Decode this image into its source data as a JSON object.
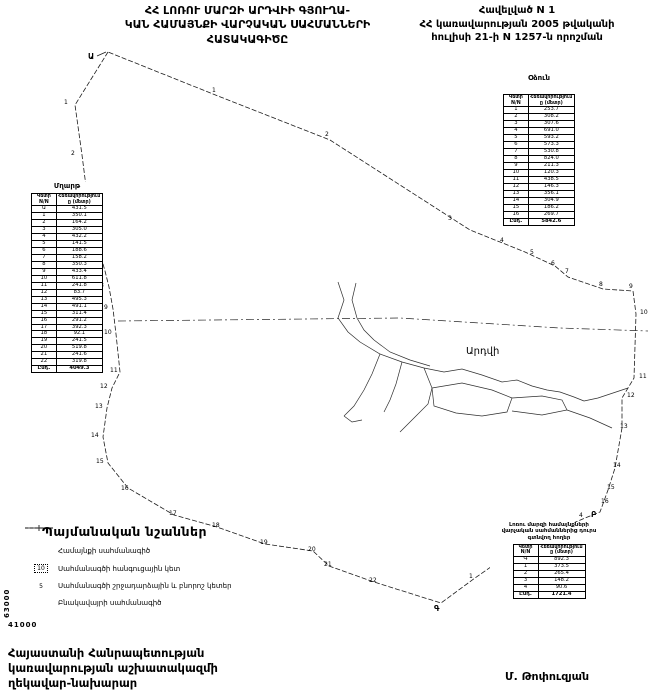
{
  "header": {
    "title_lines": [
      "ՀՀ ԼՈՌՈՒ ՄԱՐԶԻ ԱՐԴՎԻԻ ԳՅՈՒՂԱ-",
      "ԿԱՆ ՀԱՄԱՅՆՔԻ ՎԱՐՉԱԿԱՆ ՍԱՀՄԱՆՆԵՐԻ",
      "ՀԱՏԱԿԱԳԻԾԸ"
    ],
    "annex_lines": [
      "Հավելված N 1",
      "ՀՀ կառավարության 2005 թվականի",
      "հուլիսի 21-ի N 1257-ն որոշման"
    ]
  },
  "tables": {
    "left": {
      "title": "Մղարթ",
      "col1": "Կետի N/N",
      "col2": "Հեռավորությունը (մետր)",
      "rows": [
        [
          "Ա",
          "431.5"
        ],
        [
          "1",
          "350.1"
        ],
        [
          "2",
          "164.2"
        ],
        [
          "3",
          "305.0"
        ],
        [
          "4",
          "432.2"
        ],
        [
          "5",
          "141.5"
        ],
        [
          "6",
          "188.6"
        ],
        [
          "7",
          "158.2"
        ],
        [
          "8",
          "350.3"
        ],
        [
          "9",
          "433.4"
        ],
        [
          "10",
          "611.8"
        ],
        [
          "11",
          "241.8"
        ],
        [
          "12",
          "83.7"
        ],
        [
          "13",
          "495.3"
        ],
        [
          "14",
          "491.1"
        ],
        [
          "15",
          "311.4"
        ],
        [
          "16",
          "291.2"
        ],
        [
          "17",
          "392.3"
        ],
        [
          "18",
          "92.1"
        ],
        [
          "19",
          "241.5"
        ],
        [
          "20",
          "519.8"
        ],
        [
          "21",
          "241.6"
        ],
        [
          "22",
          "319.8"
        ]
      ],
      "total_label": "Ընդ.",
      "total": "4049.3"
    },
    "right": {
      "title": "Օձուն",
      "col1": "Կետի N/N",
      "col2": "Հեռավորությունը (մետր)",
      "rows": [
        [
          "1",
          "253.7"
        ],
        [
          "2",
          "308.2"
        ],
        [
          "3",
          "307.6"
        ],
        [
          "4",
          "691.0"
        ],
        [
          "5",
          "593.2"
        ],
        [
          "6",
          "573.3"
        ],
        [
          "7",
          "530.8"
        ],
        [
          "8",
          "824.0"
        ],
        [
          "9",
          "211.3"
        ],
        [
          "10",
          "120.3"
        ],
        [
          "11",
          "438.5"
        ],
        [
          "12",
          "146.3"
        ],
        [
          "13",
          "356.1"
        ],
        [
          "14",
          "304.9"
        ],
        [
          "15",
          "186.2"
        ],
        [
          "16",
          "269.7"
        ]
      ],
      "total_label": "Ընդ.",
      "total": "5842.6"
    },
    "outside": {
      "title_lines": [
        "Լոռու մարզի համայնքների",
        "վարչական սահմաններից դուրս",
        "գտնվող հողեր"
      ],
      "col1": "Կետի N/N",
      "col2": "Հեռավորությունը (մետր)",
      "rows": [
        [
          "Գ",
          "892.3"
        ],
        [
          "1",
          "373.5"
        ],
        [
          "2",
          "265.4"
        ],
        [
          "3",
          "148.2"
        ],
        [
          "4",
          "90.6"
        ]
      ],
      "total_label": "Ընդ.",
      "total": "1721.4"
    }
  },
  "legend": {
    "title": "Պայմանական նշաններ",
    "items": [
      {
        "symbol": "community-boundary-line",
        "label": "Համայնքի սահմանագիծ"
      },
      {
        "symbol": "junction-point",
        "symbol_text": "10",
        "label": "Սահմանագծի հանգուցային կետ"
      },
      {
        "symbol": "turning-point",
        "symbol_text": "5",
        "label": "Սահմանագծի շրջադարձային և բնորոշ կետեր"
      },
      {
        "symbol": "settlement-boundary-line",
        "label": "Բնակավայրի սահմանագիծ"
      }
    ]
  },
  "map": {
    "settlement_label": "Արդվի",
    "point_groups": {
      "junctions": [
        {
          "n": "Ա",
          "x": 88,
          "y": 59,
          "big": true
        },
        {
          "n": "Բ",
          "x": 591,
          "y": 517,
          "big": true
        },
        {
          "n": "Գ",
          "x": 434,
          "y": 611,
          "big": true
        }
      ],
      "mghart": [
        {
          "n": "1",
          "x": 64,
          "y": 104
        },
        {
          "n": "2",
          "x": 71,
          "y": 155
        },
        {
          "n": "3",
          "x": 77,
          "y": 202
        },
        {
          "n": "4",
          "x": 82,
          "y": 222
        },
        {
          "n": "5",
          "x": 87,
          "y": 241
        },
        {
          "n": "6",
          "x": 92,
          "y": 257
        },
        {
          "n": "7",
          "x": 96,
          "y": 271
        },
        {
          "n": "8",
          "x": 100,
          "y": 287
        },
        {
          "n": "9",
          "x": 104,
          "y": 309
        },
        {
          "n": "10",
          "x": 104,
          "y": 334
        },
        {
          "n": "11",
          "x": 110,
          "y": 372
        },
        {
          "n": "12",
          "x": 100,
          "y": 388
        },
        {
          "n": "13",
          "x": 95,
          "y": 408
        },
        {
          "n": "14",
          "x": 91,
          "y": 437
        },
        {
          "n": "15",
          "x": 96,
          "y": 463
        },
        {
          "n": "16",
          "x": 121,
          "y": 490
        },
        {
          "n": "17",
          "x": 169,
          "y": 515
        },
        {
          "n": "18",
          "x": 212,
          "y": 527
        },
        {
          "n": "19",
          "x": 260,
          "y": 544
        },
        {
          "n": "20",
          "x": 308,
          "y": 551
        },
        {
          "n": "21",
          "x": 324,
          "y": 566
        },
        {
          "n": "22",
          "x": 369,
          "y": 582
        }
      ],
      "odzun": [
        {
          "n": "1",
          "x": 212,
          "y": 92
        },
        {
          "n": "2",
          "x": 325,
          "y": 136
        },
        {
          "n": "3",
          "x": 448,
          "y": 220
        },
        {
          "n": "4",
          "x": 500,
          "y": 242
        },
        {
          "n": "5",
          "x": 530,
          "y": 254
        },
        {
          "n": "6",
          "x": 551,
          "y": 265
        },
        {
          "n": "7",
          "x": 565,
          "y": 273
        },
        {
          "n": "8",
          "x": 599,
          "y": 286
        },
        {
          "n": "9",
          "x": 629,
          "y": 288
        },
        {
          "n": "10",
          "x": 640,
          "y": 314
        },
        {
          "n": "11",
          "x": 639,
          "y": 378
        },
        {
          "n": "12",
          "x": 627,
          "y": 397
        },
        {
          "n": "13",
          "x": 620,
          "y": 428
        },
        {
          "n": "14",
          "x": 613,
          "y": 467
        },
        {
          "n": "15",
          "x": 607,
          "y": 489
        },
        {
          "n": "16",
          "x": 601,
          "y": 503
        }
      ],
      "outside": [
        {
          "n": "1",
          "x": 469,
          "y": 578
        },
        {
          "n": "2",
          "x": 510,
          "y": 549
        },
        {
          "n": "3",
          "x": 550,
          "y": 530
        },
        {
          "n": "4",
          "x": 579,
          "y": 517
        }
      ]
    }
  },
  "grid": {
    "left_vertical": "63000",
    "bottom": "41000"
  },
  "footer": {
    "lines": [
      "Հայաստանի Հանրապետության",
      "կառավարության աշխատակազմի",
      "ղեկավար-նախարար"
    ],
    "signature": "Մ. Թոփուզյան"
  }
}
